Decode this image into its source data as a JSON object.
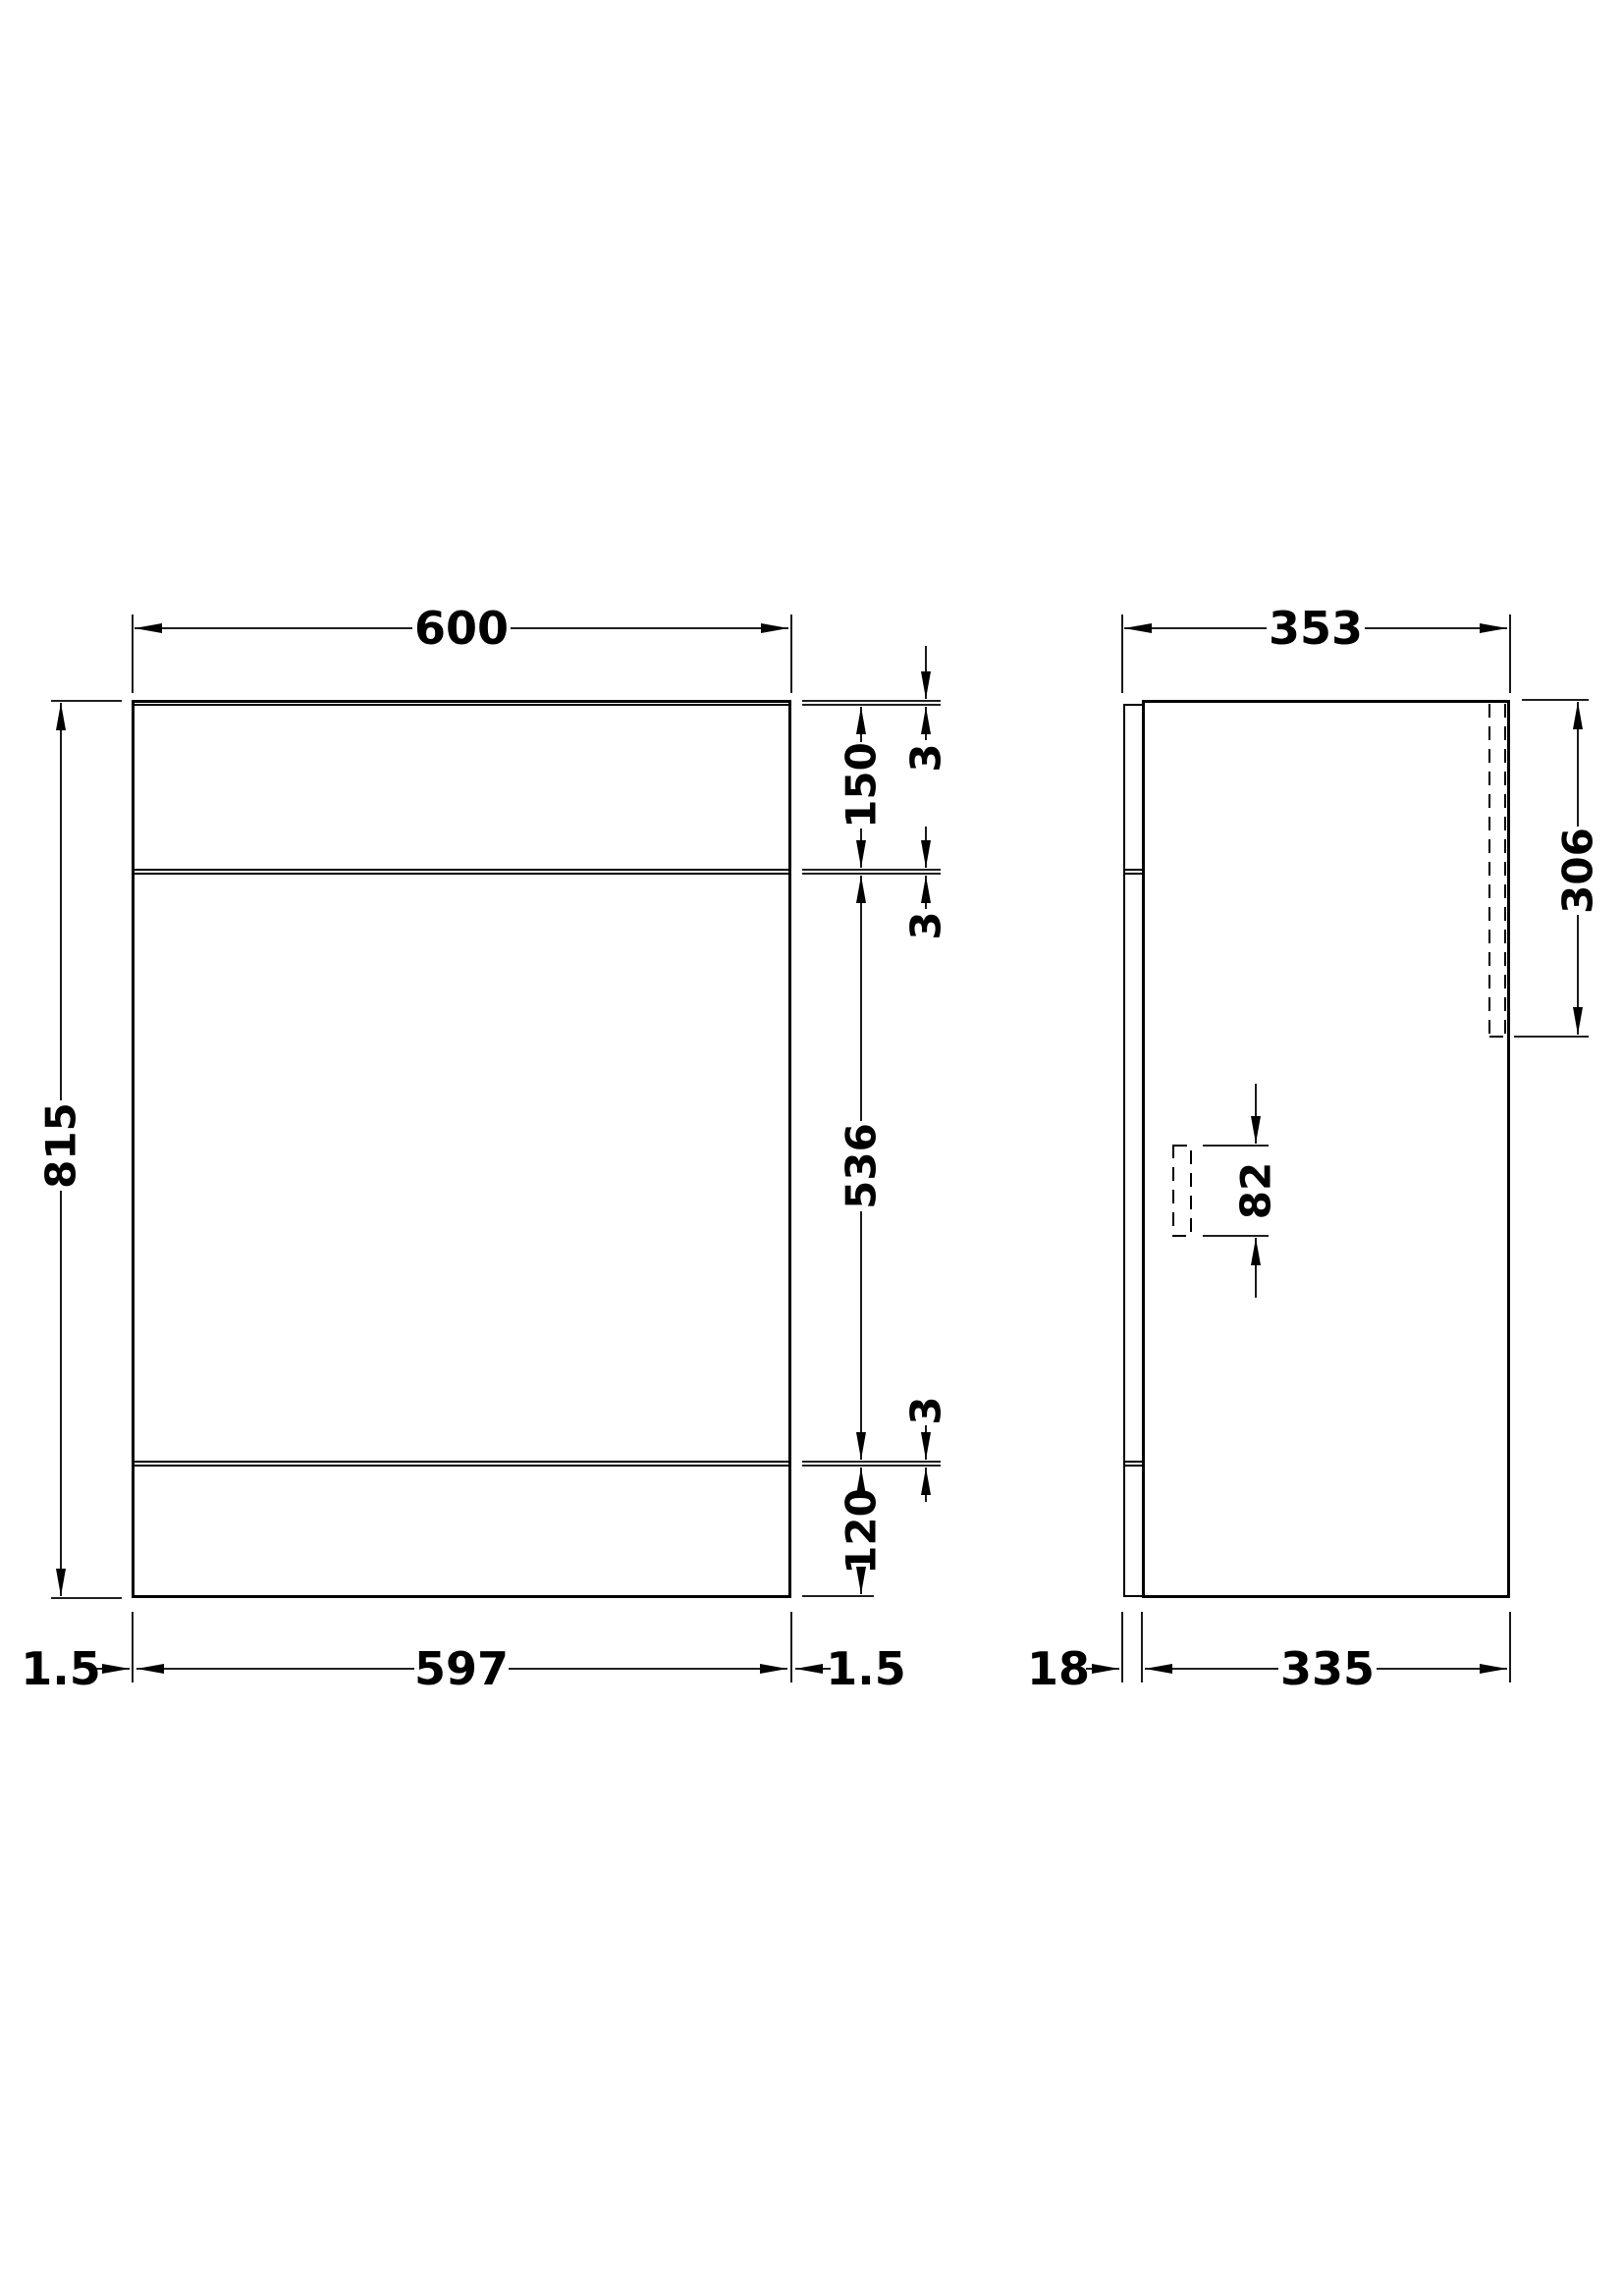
{
  "drawing": {
    "background_color": "#ffffff",
    "line_color": "#000000",
    "front_view": {
      "labels": {
        "overall_width": "600",
        "overall_height": "815",
        "top_panel_thickness": "3",
        "top_section_height": "150",
        "upper_gap": "3",
        "door_section_height": "536",
        "lower_gap": "3",
        "plinth_height": "120",
        "left_inset": "1.5",
        "opening_width": "597",
        "right_inset": "1.5"
      }
    },
    "side_view": {
      "labels": {
        "overall_depth": "353",
        "recess_height": "306",
        "bracket_height": "82",
        "front_panel_thickness": "18",
        "body_depth": "335"
      }
    }
  }
}
